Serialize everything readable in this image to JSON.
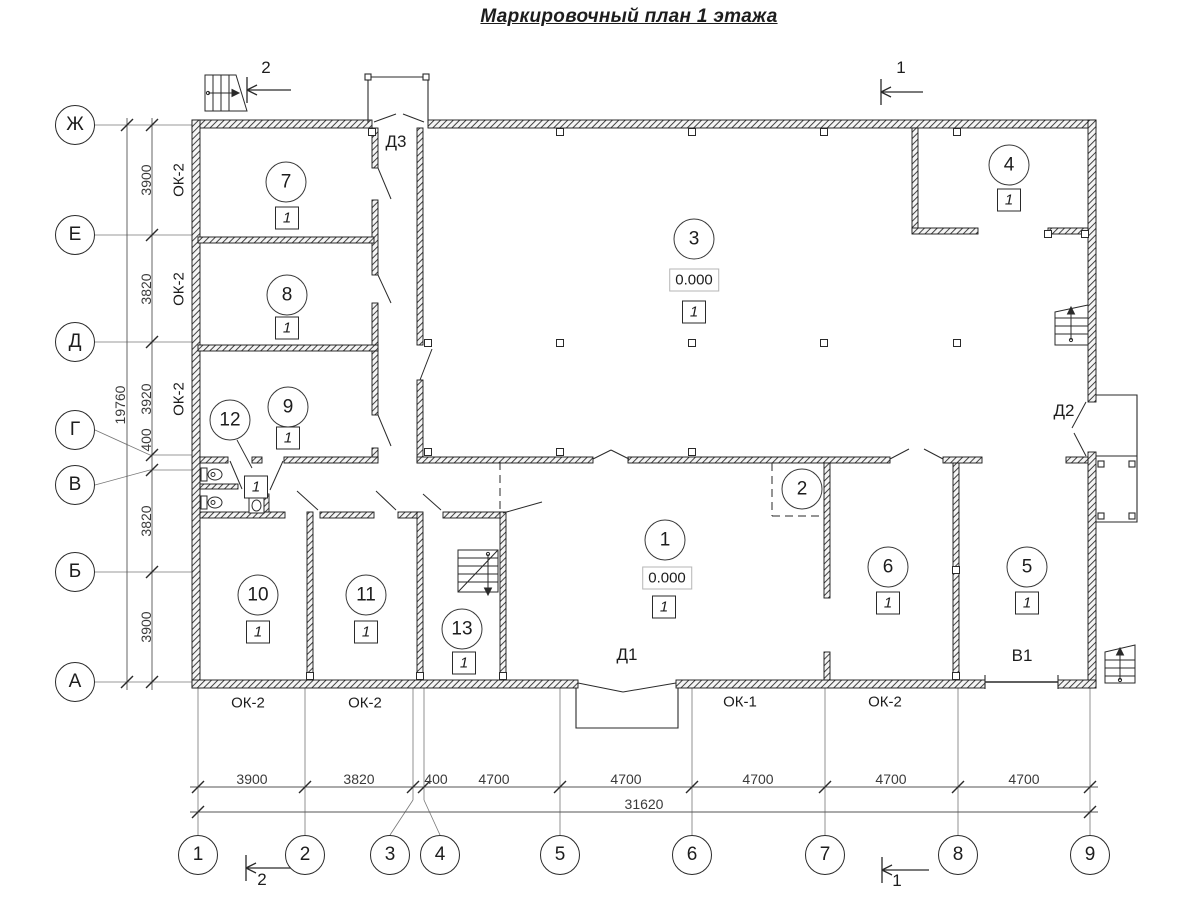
{
  "title": "Маркировочный план 1 этажа",
  "axes": {
    "rows": [
      {
        "label": "Ж"
      },
      {
        "label": "Е"
      },
      {
        "label": "Д"
      },
      {
        "label": "Г"
      },
      {
        "label": "В"
      },
      {
        "label": "Б"
      },
      {
        "label": "А"
      }
    ],
    "cols": [
      {
        "label": "1"
      },
      {
        "label": "2"
      },
      {
        "label": "3"
      },
      {
        "label": "4"
      },
      {
        "label": "5"
      },
      {
        "label": "6"
      },
      {
        "label": "7"
      },
      {
        "label": "8"
      },
      {
        "label": "9"
      }
    ]
  },
  "dims": {
    "left": {
      "values": [
        "3900",
        "3820",
        "3920",
        "400",
        "3820",
        "3900"
      ],
      "total": "19760"
    },
    "bottom": {
      "values": [
        "3900",
        "3820",
        "400",
        "4700",
        "4700",
        "4700",
        "4700",
        "4700"
      ],
      "total": "31620"
    }
  },
  "rooms": {
    "r1": {
      "number": "1",
      "finish": "1",
      "elevation": "0.000"
    },
    "r2": {
      "number": "2"
    },
    "r3": {
      "number": "3",
      "finish": "1",
      "elevation": "0.000"
    },
    "r4": {
      "number": "4",
      "finish": "1"
    },
    "r5": {
      "number": "5",
      "finish": "1"
    },
    "r6": {
      "number": "6",
      "finish": "1"
    },
    "r7": {
      "number": "7",
      "finish": "1"
    },
    "r8": {
      "number": "8",
      "finish": "1"
    },
    "r9": {
      "number": "9",
      "finish": "1"
    },
    "r10": {
      "number": "10",
      "finish": "1"
    },
    "r11": {
      "number": "11",
      "finish": "1"
    },
    "r12": {
      "number": "12",
      "finish": "1"
    },
    "r13": {
      "number": "13",
      "finish": "1"
    }
  },
  "windows": {
    "left": [
      {
        "label": "ОК-2"
      },
      {
        "label": "ОК-2"
      },
      {
        "label": "ОК-2"
      }
    ],
    "bottom": [
      {
        "label": "ОК-2"
      },
      {
        "label": "ОК-2"
      },
      {
        "label": "ОК-1"
      },
      {
        "label": "ОК-2"
      }
    ]
  },
  "doors": {
    "d1": "Д1",
    "d2": "Д2",
    "d3": "Д3",
    "v1": "В1"
  },
  "sections": {
    "top_left": "2",
    "top_right": "1",
    "bottom_left": "2",
    "bottom_right": "1"
  },
  "colors": {
    "ink": "#2a2a2a",
    "wall_hatch": "#2f2f2f",
    "dim_line": "#555555"
  }
}
